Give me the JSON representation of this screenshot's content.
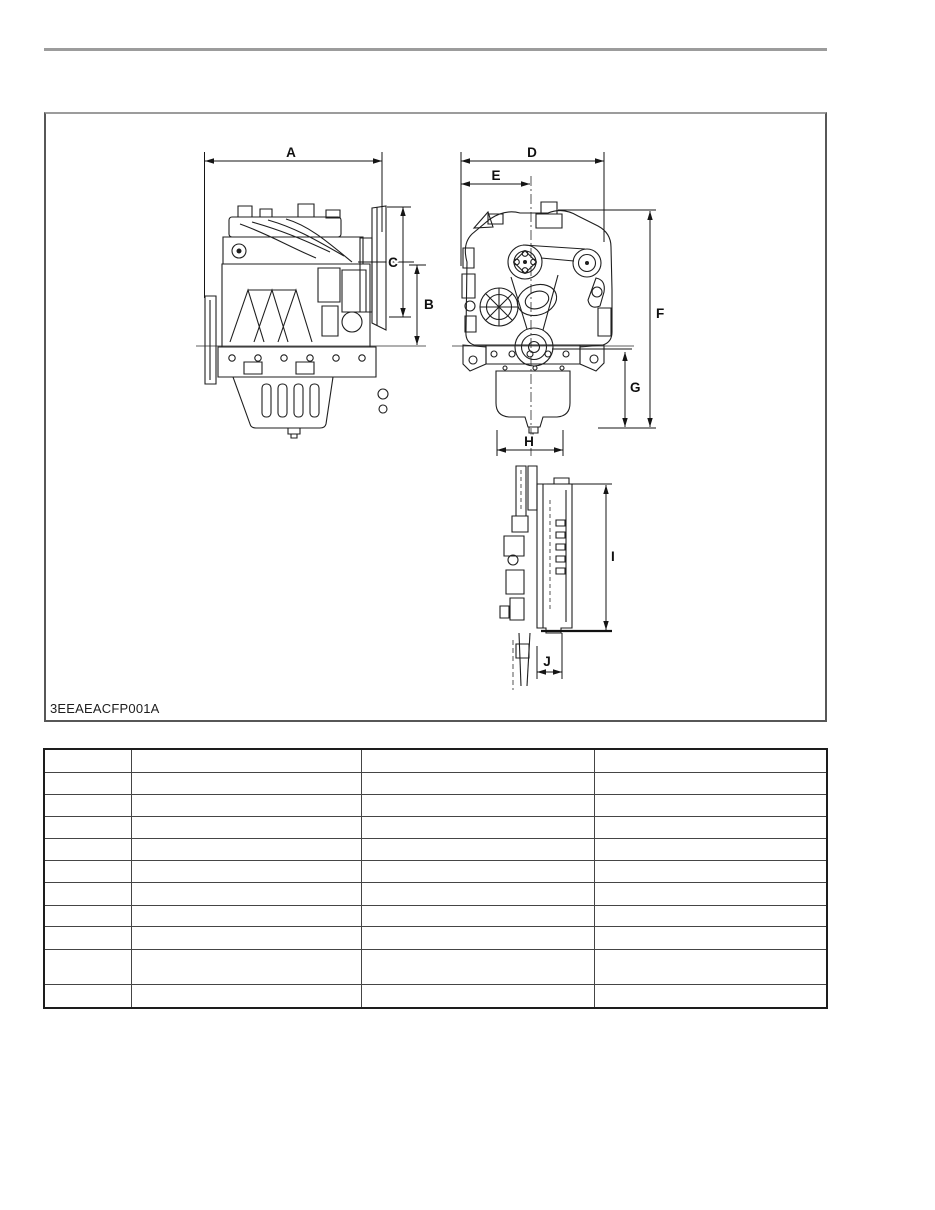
{
  "document": {
    "figure": {
      "code": "3EEAEACFP001A",
      "dims": {
        "a": "A",
        "b": "B",
        "c": "C",
        "d": "D",
        "e": "E",
        "f": "F",
        "g": "G",
        "h": "H",
        "i": "I",
        "j": "J"
      }
    },
    "table": {
      "columns": 4,
      "rows": 11,
      "cells": [
        [
          "",
          "",
          "",
          ""
        ],
        [
          "",
          "",
          "",
          ""
        ],
        [
          "",
          "",
          "",
          ""
        ],
        [
          "",
          "",
          "",
          ""
        ],
        [
          "",
          "",
          "",
          ""
        ],
        [
          "",
          "",
          "",
          ""
        ],
        [
          "",
          "",
          "",
          ""
        ],
        [
          "",
          "",
          "",
          ""
        ],
        [
          "",
          "",
          "",
          ""
        ],
        [
          "",
          "",
          "",
          ""
        ],
        [
          "",
          "",
          "",
          ""
        ]
      ]
    },
    "colors": {
      "top_rule": "#9c9c9c",
      "line_art": "#1f1f1f",
      "table_border": "#454545"
    }
  }
}
